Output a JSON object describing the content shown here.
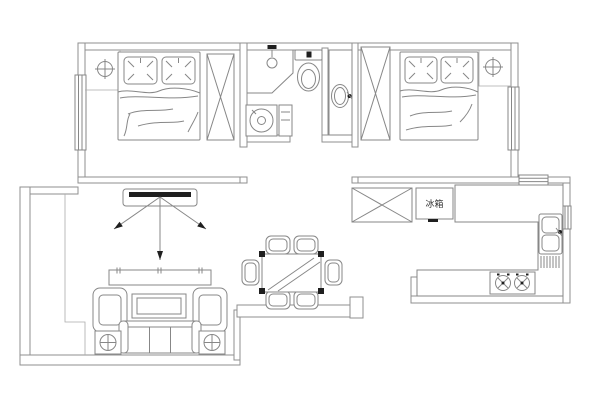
{
  "labels": {
    "fridge": "冰箱"
  },
  "colors": {
    "wall": "#8f8f8f",
    "furn": "#878787",
    "thin": "#ababab",
    "accent": "#1f1f1f",
    "bg": "#ffffff"
  },
  "icons": {
    "ceiling_light": "circle-with-cross",
    "wardrobe": "rectangle-with-x",
    "shower": "corner-stall-with-head",
    "toilet": "tank-and-bowl",
    "washing_machine": "square-with-drum-circle",
    "washbasin": "oval-with-faucet-dot",
    "kitchen_sink": "double-basin-with-faucet",
    "stove": "two-burners",
    "lamp_table": "square-with-circled-cross",
    "airflow": "three-arrows"
  }
}
